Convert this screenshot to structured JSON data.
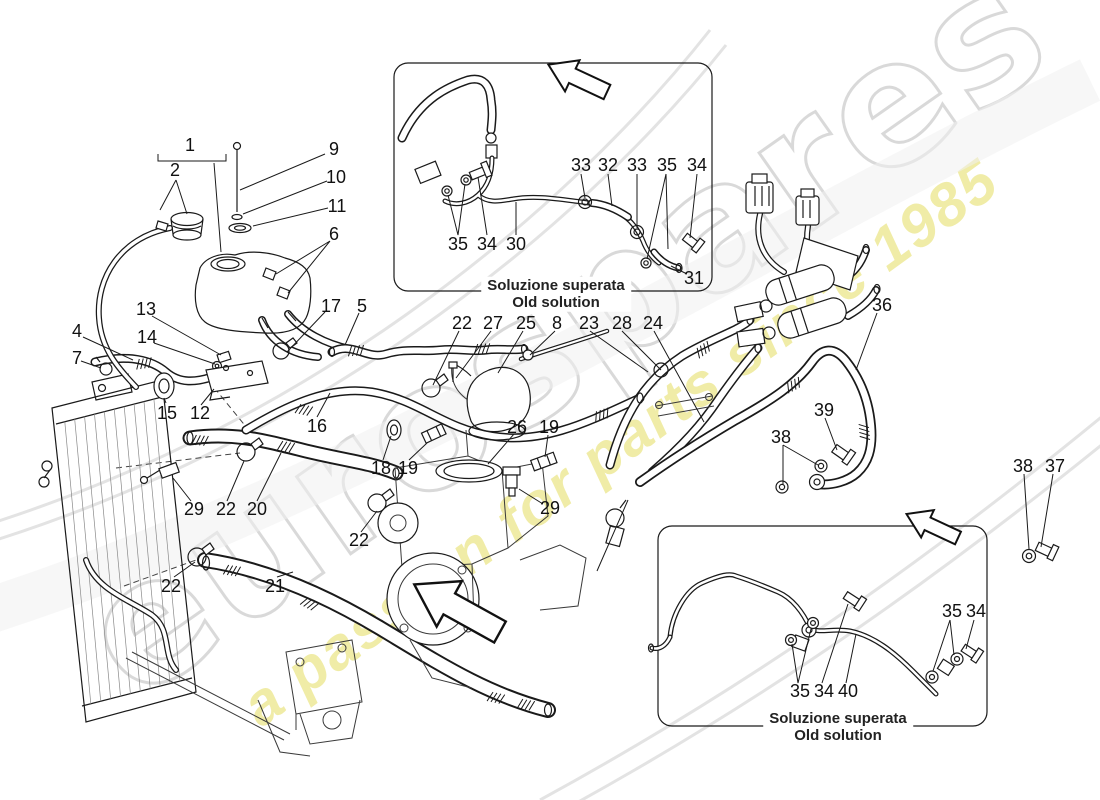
{
  "watermark": {
    "brand": "eurospares",
    "tagline": "a passion for parts since 1985",
    "brand_color": "#bababa",
    "tagline_color": "#ded43c"
  },
  "insets": {
    "top": {
      "caption_it": "Soluzione superata",
      "caption_en": "Old solution"
    },
    "bottom": {
      "caption_it": "Soluzione superata",
      "caption_en": "Old solution"
    }
  },
  "arrows": [
    {
      "name": "direction-arrow-main",
      "points": "down-left"
    },
    {
      "name": "direction-arrow-top-inset",
      "points": "down-left"
    },
    {
      "name": "direction-arrow-bottom-inset",
      "points": "down-left"
    }
  ],
  "colors": {
    "line": "#1a1a1a",
    "background": "#ffffff"
  },
  "callouts": [
    {
      "label": "1",
      "x": 190,
      "y": 145
    },
    {
      "label": "2",
      "x": 175,
      "y": 170
    },
    {
      "label": "9",
      "x": 334,
      "y": 149
    },
    {
      "label": "10",
      "x": 336,
      "y": 177
    },
    {
      "label": "11",
      "x": 337,
      "y": 206
    },
    {
      "label": "6",
      "x": 334,
      "y": 234
    },
    {
      "label": "4",
      "x": 77,
      "y": 331
    },
    {
      "label": "7",
      "x": 77,
      "y": 358
    },
    {
      "label": "13",
      "x": 146,
      "y": 309
    },
    {
      "label": "14",
      "x": 147,
      "y": 337
    },
    {
      "label": "17",
      "x": 331,
      "y": 306
    },
    {
      "label": "5",
      "x": 362,
      "y": 306
    },
    {
      "label": "15",
      "x": 167,
      "y": 413
    },
    {
      "label": "12",
      "x": 200,
      "y": 413
    },
    {
      "label": "16",
      "x": 317,
      "y": 426
    },
    {
      "label": "29",
      "x": 194,
      "y": 509
    },
    {
      "label": "22",
      "x": 226,
      "y": 509
    },
    {
      "label": "20",
      "x": 257,
      "y": 509
    },
    {
      "label": "22",
      "x": 171,
      "y": 586
    },
    {
      "label": "21",
      "x": 275,
      "y": 586
    },
    {
      "label": "22",
      "x": 359,
      "y": 540
    },
    {
      "label": "22",
      "x": 462,
      "y": 323
    },
    {
      "label": "27",
      "x": 493,
      "y": 323
    },
    {
      "label": "25",
      "x": 526,
      "y": 323
    },
    {
      "label": "8",
      "x": 557,
      "y": 323
    },
    {
      "label": "23",
      "x": 589,
      "y": 323
    },
    {
      "label": "28",
      "x": 622,
      "y": 323
    },
    {
      "label": "24",
      "x": 653,
      "y": 323
    },
    {
      "label": "26",
      "x": 517,
      "y": 427
    },
    {
      "label": "19",
      "x": 549,
      "y": 427
    },
    {
      "label": "18",
      "x": 381,
      "y": 468
    },
    {
      "label": "19",
      "x": 408,
      "y": 468
    },
    {
      "label": "29",
      "x": 550,
      "y": 508
    },
    {
      "label": "36",
      "x": 882,
      "y": 305
    },
    {
      "label": "39",
      "x": 824,
      "y": 410
    },
    {
      "label": "38",
      "x": 781,
      "y": 437
    },
    {
      "label": "38",
      "x": 1023,
      "y": 466
    },
    {
      "label": "37",
      "x": 1055,
      "y": 466
    },
    {
      "label": "33",
      "x": 581,
      "y": 165
    },
    {
      "label": "32",
      "x": 608,
      "y": 165
    },
    {
      "label": "33",
      "x": 637,
      "y": 165
    },
    {
      "label": "35",
      "x": 667,
      "y": 165
    },
    {
      "label": "34",
      "x": 697,
      "y": 165
    },
    {
      "label": "35",
      "x": 458,
      "y": 244
    },
    {
      "label": "34",
      "x": 487,
      "y": 244
    },
    {
      "label": "30",
      "x": 516,
      "y": 244
    },
    {
      "label": "31",
      "x": 694,
      "y": 278
    },
    {
      "label": "35",
      "x": 952,
      "y": 611
    },
    {
      "label": "34",
      "x": 976,
      "y": 611
    },
    {
      "label": "35",
      "x": 800,
      "y": 691
    },
    {
      "label": "34",
      "x": 824,
      "y": 691
    },
    {
      "label": "40",
      "x": 848,
      "y": 691
    }
  ]
}
